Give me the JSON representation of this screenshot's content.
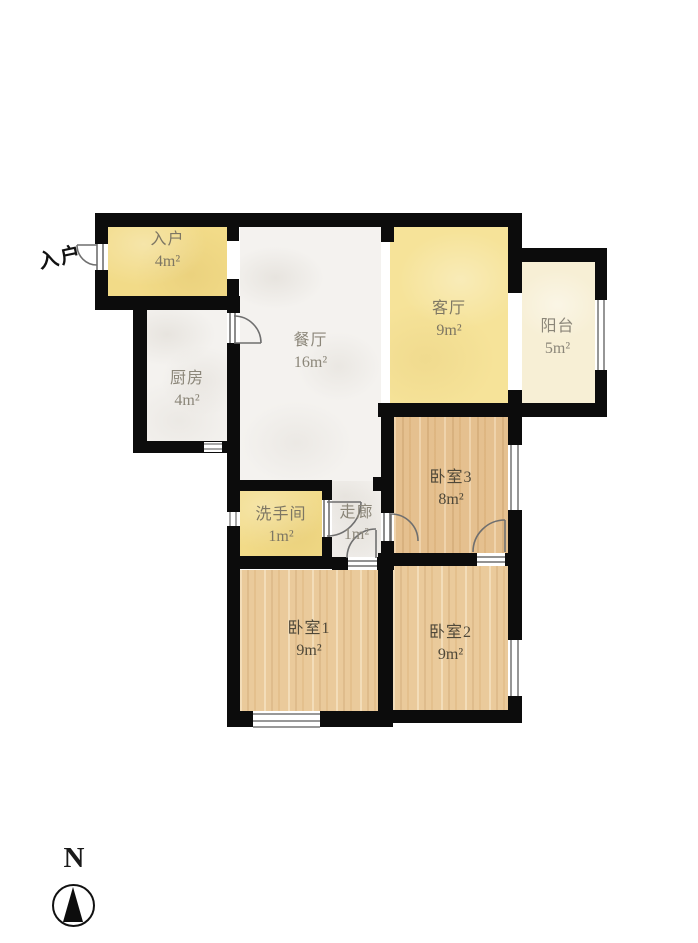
{
  "plan": {
    "exterior_entrance_label": "入户",
    "compass": {
      "label": "N"
    },
    "rooms": [
      {
        "id": "entry",
        "name": "入户",
        "area": "4m²"
      },
      {
        "id": "kitchen",
        "name": "厨房",
        "area": "4m²"
      },
      {
        "id": "dining",
        "name": "餐厅",
        "area": "16m²"
      },
      {
        "id": "living",
        "name": "客厅",
        "area": "9m²"
      },
      {
        "id": "balcony",
        "name": "阳台",
        "area": "5m²"
      },
      {
        "id": "bedroom3",
        "name": "卧室3",
        "area": "8m²"
      },
      {
        "id": "bathroom",
        "name": "洗手间",
        "area": "1m²"
      },
      {
        "id": "corridor",
        "name": "走廊",
        "area": "1m²"
      },
      {
        "id": "bedroom1",
        "name": "卧室1",
        "area": "9m²"
      },
      {
        "id": "bedroom2",
        "name": "卧室2",
        "area": "9m²"
      }
    ],
    "colors": {
      "wall": "#0c0c0c",
      "entry_yellow": "#f2db88",
      "living_yellow": "#f6e399",
      "balcony_pale": "#f7efd5",
      "tile_white": "#f4f2ef",
      "wood": "#eaca9b",
      "wood_deep": "#e5c08f",
      "door_line": "#6f6f6f",
      "label_light": "#8b8679",
      "label_dark": "#4f4839"
    }
  }
}
